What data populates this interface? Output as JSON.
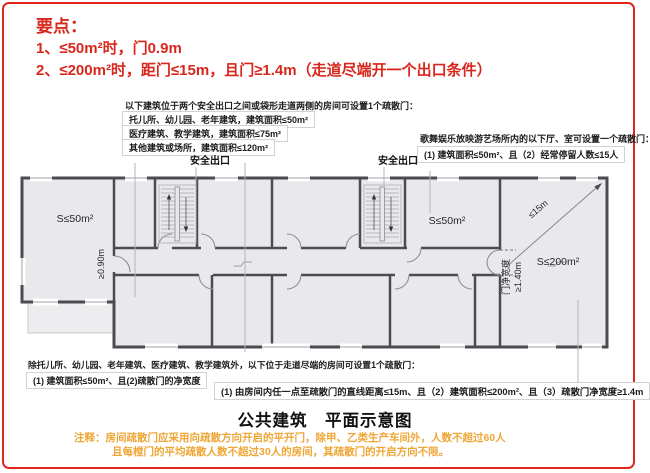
{
  "colors": {
    "frame_red": "#e3261d",
    "accent_red": "#d8271c",
    "note_orange": "#efa636",
    "plan_fill": "#e9e9ec",
    "wall_gray": "#4b4b52"
  },
  "key_points": {
    "heading": "要点：",
    "point1": "1、≤50m²时，门0.9m",
    "point2": "2、≤200m²时，距门≤15m，且门≥1.4m（走道尽端开一个出口条件）"
  },
  "note_top": {
    "intro": "以下建筑位于两个安全出口之间或袋形走道两侧的房间可设置1个疏散门：",
    "items": [
      "托儿所、幼儿园、老年建筑，建筑面积≤50m²",
      "医疗建筑、教学建筑，建筑面积≤75m²",
      "其他建筑或场所，建筑面积≤120m²"
    ]
  },
  "note_right": {
    "intro": "歌舞娱乐放映游艺场所内的以下厅、室可设置一个疏散门：",
    "rule": "(1) 建筑面积≤50m²、且（2）经常停留人数≤15人"
  },
  "plan": {
    "exit_label": "安全出口",
    "room_small": "S≤50m²",
    "room_large": "S≤200m²",
    "door_min_width_small": "≥0.90m",
    "door_width_caption": "门净宽度",
    "door_min_width_large": "≥1.40m",
    "max_distance": "≤15m"
  },
  "note_bottom": {
    "intro": "除托儿所、幼儿园、老年建筑、医疗建筑、教学建筑外，以下位于走道尽端的房间可设置1个疏散门：",
    "rule_small": "(1) 建筑面积≤50m²、且(2)疏散门的净宽度",
    "rule_large": "(1) 由房间内任一点至疏散门的直线距离≤15m、且（2）建筑面积≤200m²、且（3）疏散门净宽度≥1.4m"
  },
  "footer": {
    "title": "公共建筑　平面示意图",
    "note_line1": "注释：房间疏散门应采用向疏散方向开启的平开门，除甲、乙类生产车间外，人数不超过60人",
    "note_line2": "且每樘门的平均疏散人数不超过30人的房间，其疏散门的开启方向不限。"
  }
}
